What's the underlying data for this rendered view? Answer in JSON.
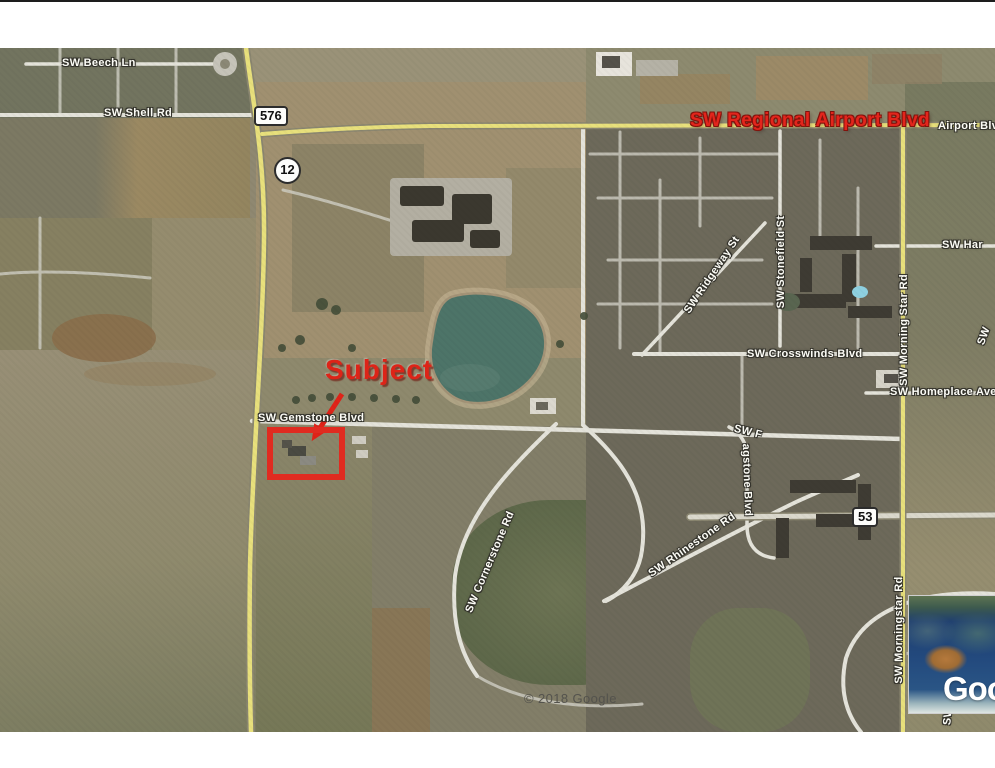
{
  "map": {
    "attribution": "© 2018 Google",
    "annotation": {
      "subject": "Subject"
    },
    "shields": {
      "s576": "576",
      "s12": "12",
      "s53": "53"
    },
    "labels": {
      "beech": "SW Beech Ln",
      "shell": "SW Shell Rd",
      "regional_airport": "SW Regional Airport Blvd",
      "airport_partial": "Airport Blv",
      "har_partial": "SW Har",
      "ridgeway": "SW Ridgeway St",
      "stonefield": "SW Stonefield St",
      "morning_star": "SW Morning Star Rd",
      "crosswinds": "SW Crosswinds Blvd",
      "homeplace": "SW Homeplace Ave",
      "gemstone": "SW Gemstone Blvd",
      "cornerstone": "SW Cornerstone Rd",
      "rhinestone": "SW Rhinestone Rd",
      "flagstone_start": "SW F",
      "flagstone_rest": "agstone Blvd",
      "morningstar_south": "SW Morningstar Rd",
      "sw_partial": "SW"
    },
    "inset": {
      "logo_partial": "Goo"
    },
    "colors": {
      "annotation_red": "#e02b20",
      "road_yellow": "#e8e07c",
      "road_white": "#e4e3da",
      "pond": "#4d7468"
    }
  }
}
